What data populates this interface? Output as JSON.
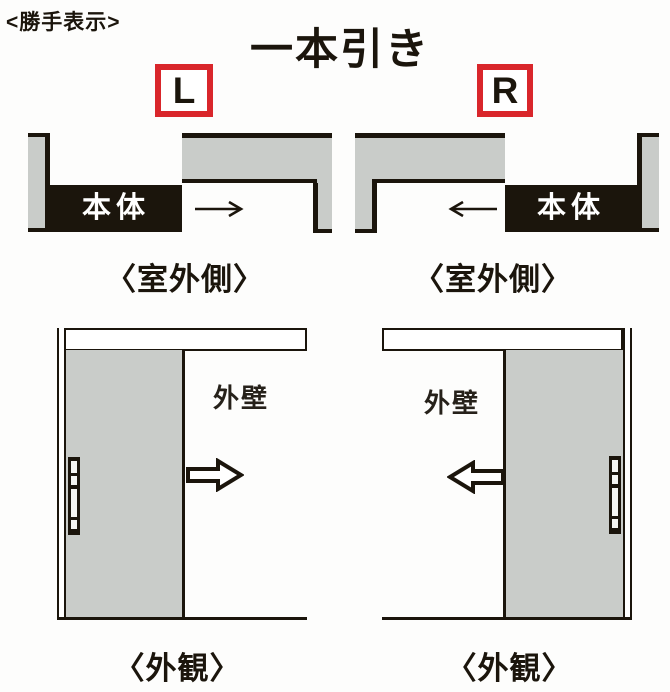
{
  "meta": {
    "section_label": "<勝手表示>",
    "title": "一本引き"
  },
  "colors": {
    "accent_red": "#d9262b",
    "panel_gray": "#c9ccc9",
    "ink": "#1b150c"
  },
  "left_variant": {
    "code": "L",
    "slide_direction": "right",
    "plan": {
      "body_label": "本体",
      "caption": "〈室外側〉"
    },
    "elevation": {
      "wall_label": "外壁",
      "caption": "〈外観〉"
    }
  },
  "right_variant": {
    "code": "R",
    "slide_direction": "left",
    "plan": {
      "body_label": "本体",
      "caption": "〈室外側〉"
    },
    "elevation": {
      "wall_label": "外壁",
      "caption": "〈外観〉"
    }
  }
}
